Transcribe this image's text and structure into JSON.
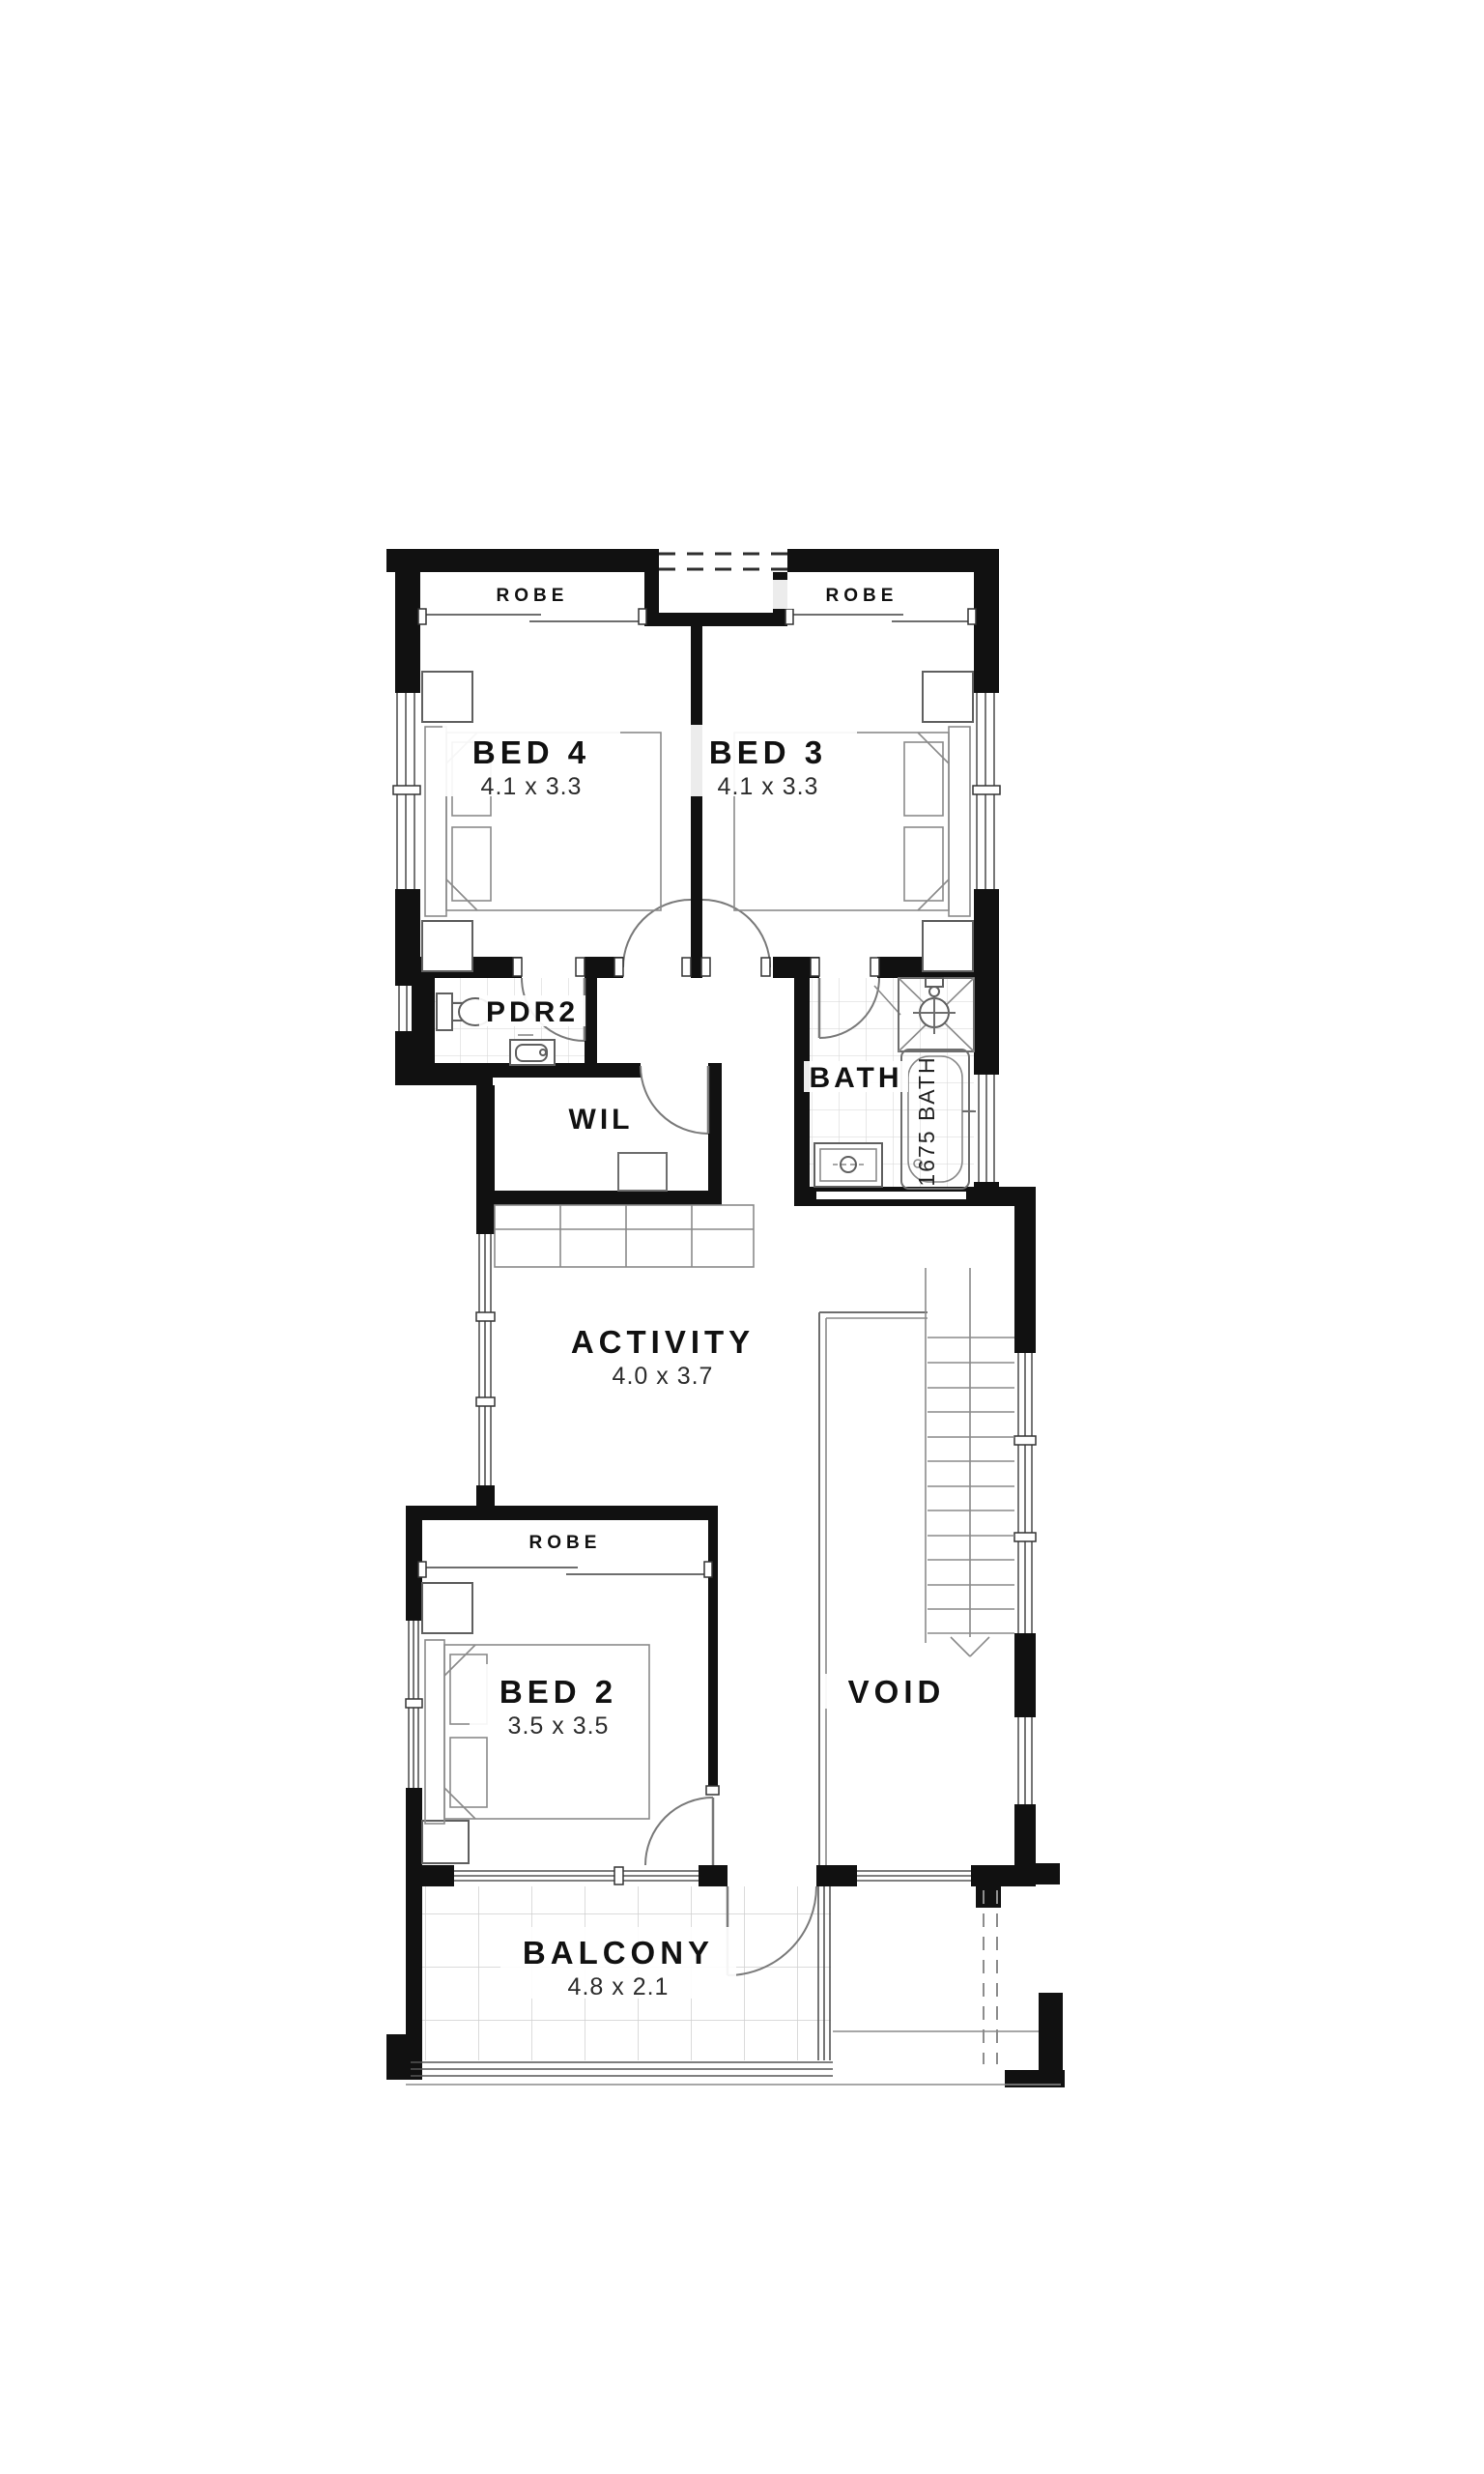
{
  "plan": {
    "title": "upper-floor-plan",
    "rooms": {
      "bed4": {
        "name": "BED 4",
        "dims": "4.1 x 3.3"
      },
      "bed3": {
        "name": "BED 3",
        "dims": "4.1 x 3.3"
      },
      "bed2": {
        "name": "BED 2",
        "dims": "3.5 x 3.5"
      },
      "activity": {
        "name": "ACTIVITY",
        "dims": "4.0 x 3.7"
      },
      "balcony": {
        "name": "BALCONY",
        "dims": "4.8 x 2.1"
      },
      "pdr2": {
        "name": "PDR2"
      },
      "wil": {
        "name": "WIL"
      },
      "bath": {
        "name": "BATH"
      },
      "void": {
        "name": "VOID"
      }
    },
    "labels": {
      "robe_bed4": "ROBE",
      "robe_bed3": "ROBE",
      "robe_bed2": "ROBE",
      "bath_tub": "1675 BATH"
    },
    "fixtures": {
      "bed4": "double-bed",
      "bed3": "double-bed",
      "bed2": "double-bed",
      "pdr2": [
        "toilet",
        "basin"
      ],
      "bath": [
        "shower",
        "bathtub",
        "vanity"
      ],
      "stair": "staircase-with-down-arrow"
    },
    "colors": {
      "wall": "#111111",
      "line": "#6e6e6e",
      "tile": "#d9d9d9",
      "background": "#ffffff"
    }
  }
}
